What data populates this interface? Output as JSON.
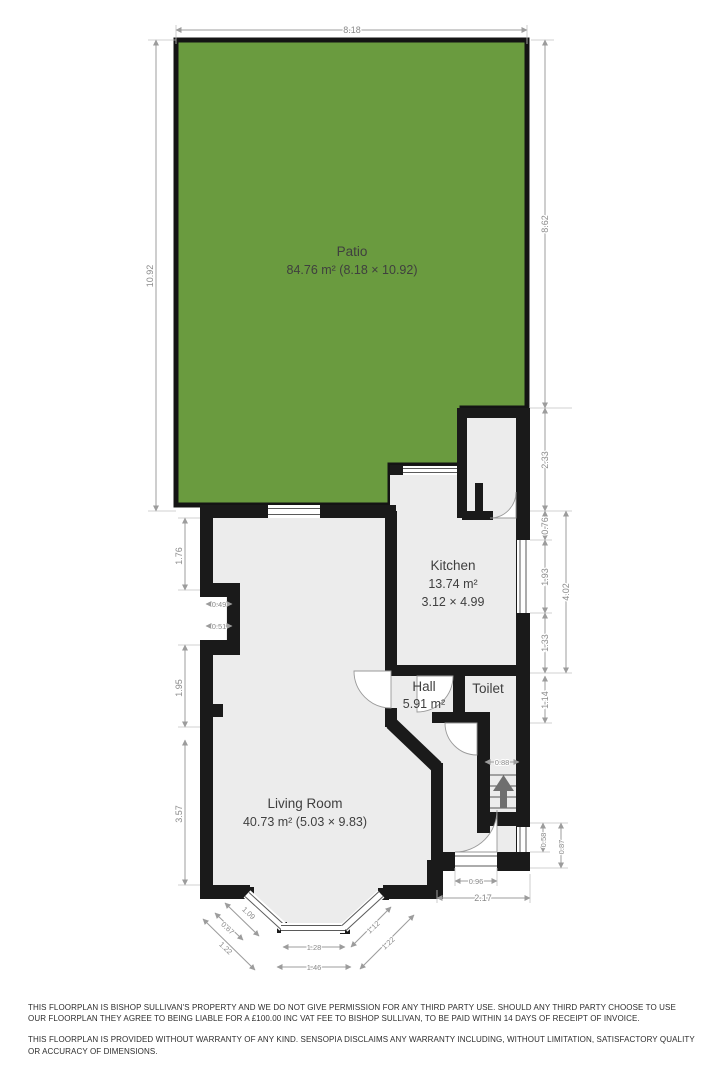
{
  "floorplan": {
    "rooms": {
      "patio": {
        "name": "Patio",
        "area": "84.76 m² (8.18 × 10.92)"
      },
      "kitchen": {
        "name": "Kitchen",
        "area": "13.74 m²",
        "size": "3.12 × 4.99"
      },
      "hall": {
        "name": "Hall",
        "area": "5.91 m²"
      },
      "toilet": {
        "name": "Toilet"
      },
      "living_room": {
        "name": "Living Room",
        "area": "40.73 m² (5.03 × 9.83)"
      }
    },
    "dims": {
      "patio_top": "8.18",
      "patio_left": "10.92",
      "patio_right": "8.62",
      "ext_right": "2.33",
      "kwin_above": "0.76",
      "kwin": "1.93",
      "kwin_below": "1.33",
      "kright_total": "4.02",
      "toilet_right": "1.14",
      "stairs": "0.88",
      "fwin": "0.58",
      "fright": "0.87",
      "lupper": "1.76",
      "niche_top": "0.49",
      "niche_bottom": "0.51",
      "lmid": "1.95",
      "llower": "3.57",
      "fdoor": "0.96",
      "ftotal": "2.17",
      "bay_l1": "1.09",
      "bay_l2": "0.67",
      "bay_l3": "1.22",
      "bay_f1": "1.28",
      "bay_f2": "1.46",
      "bay_r1": "1.12",
      "bay_r2": "1.22"
    },
    "colors": {
      "patio": "#6a9b3f",
      "interior": "#ececec",
      "wall": "#1a1a1a"
    }
  },
  "footer": {
    "para1": "THIS FLOORPLAN IS BISHOP SULLIVAN'S PROPERTY AND WE DO NOT GIVE PERMISSION FOR ANY THIRD PARTY USE. SHOULD ANY THIRD PARTY CHOOSE TO USE OUR FLOORPLAN THEY AGREE TO BEING LIABLE FOR A £100.00 INC VAT FEE TO BISHOP SULLIVAN, TO BE PAID WITHIN 14 DAYS OF RECEIPT OF INVOICE.",
    "para2": "THIS FLOORPLAN IS PROVIDED WITHOUT WARRANTY OF ANY KIND. SENSOPIA DISCLAIMS ANY WARRANTY INCLUDING, WITHOUT LIMITATION, SATISFACTORY QUALITY OR ACCURACY OF DIMENSIONS."
  }
}
